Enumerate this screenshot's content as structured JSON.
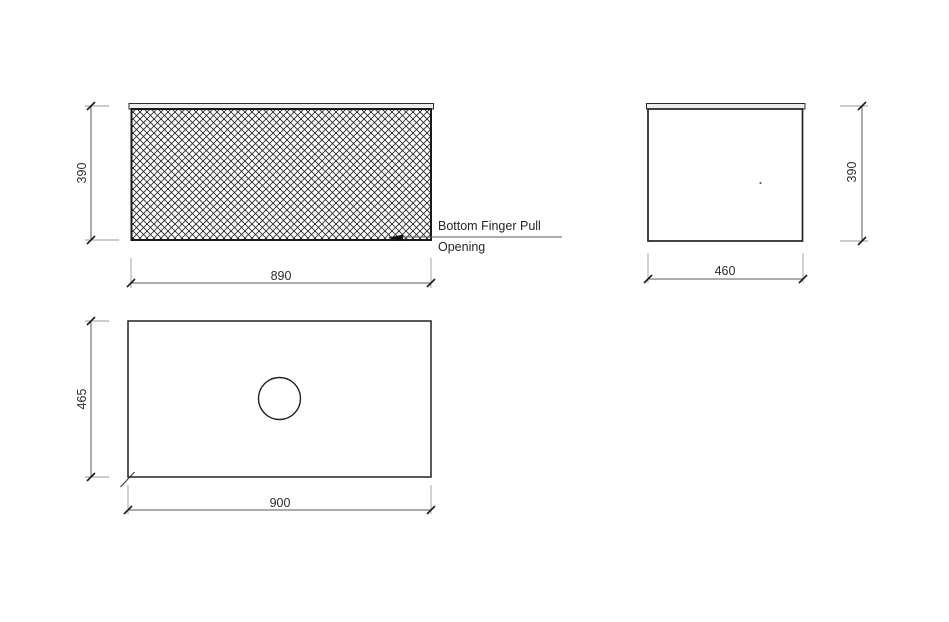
{
  "drawing": {
    "views": {
      "front_elevation": {
        "height_dim": "390",
        "width_dim": "890",
        "callout": {
          "line1": "Bottom Finger Pull",
          "line2": "Opening"
        }
      },
      "side_elevation": {
        "height_dim": "390",
        "width_dim": "460"
      },
      "plan": {
        "depth_dim": "465",
        "width_dim": "900"
      }
    },
    "colors": {
      "object_line": "#1f1f1f",
      "dimension_line": "#5a5a5a",
      "extension_line": "#9a9a9a",
      "hatch_line": "#2b2b2b",
      "countertop_fill": "#ececec",
      "background": "#ffffff"
    }
  }
}
